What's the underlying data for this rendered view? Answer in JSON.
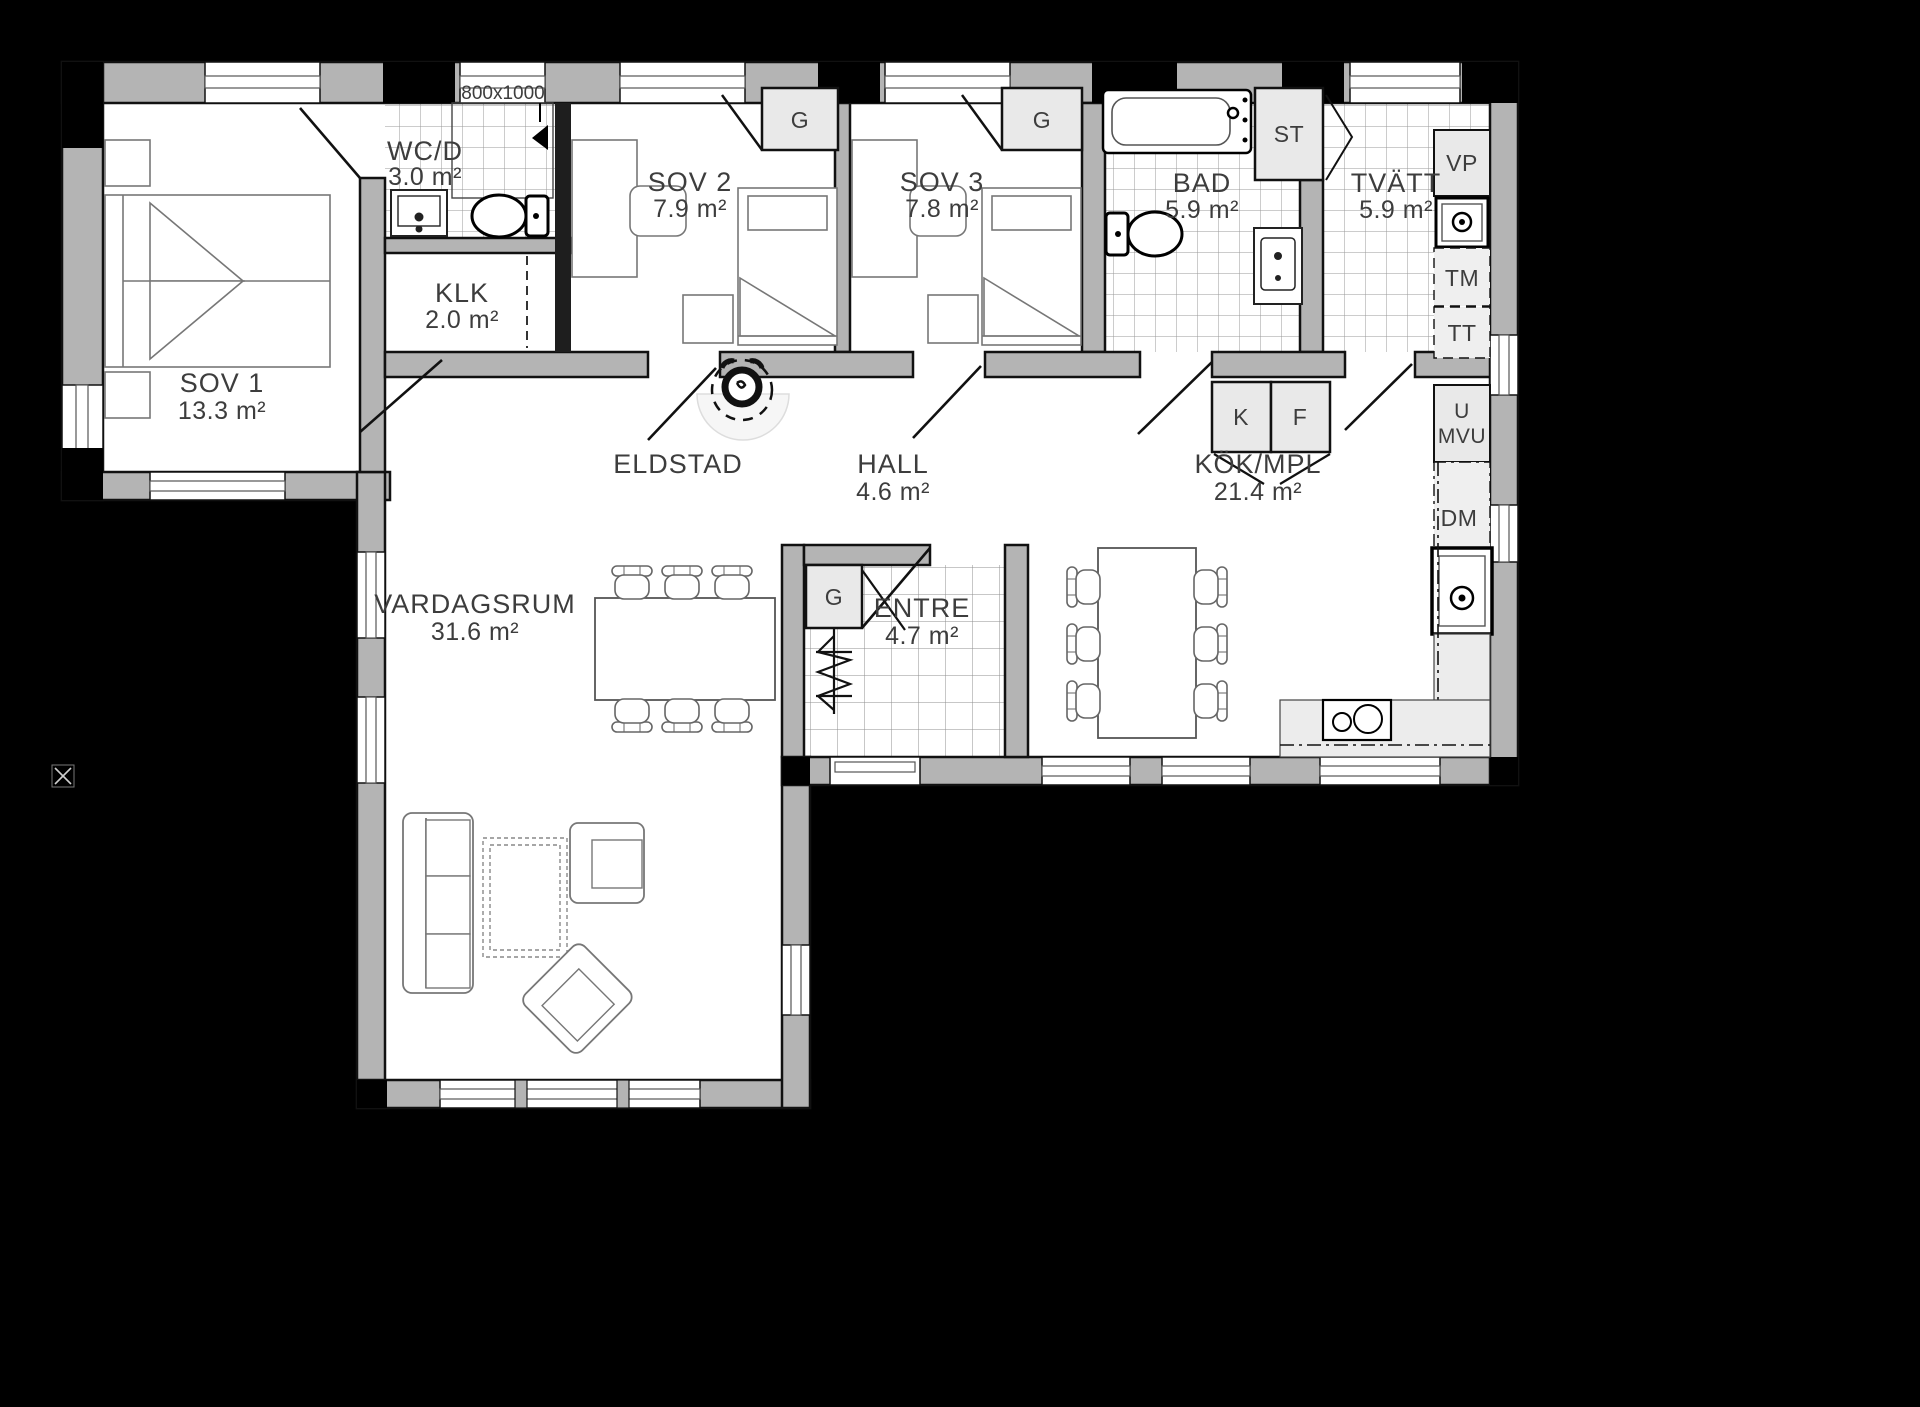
{
  "plan": {
    "type": "floorplan",
    "language": "Swedish",
    "colors": {
      "background": "#000000",
      "wall": "#b4b4b4",
      "floor": "#ffffff",
      "line": "#1c1c1c",
      "tile_line": "#9a9a9a",
      "cabinet_fill": "#e9e9e9",
      "label": "#3d3d3d"
    }
  },
  "rooms": {
    "sov1": {
      "name": "SOV 1",
      "area": "13.3 m²"
    },
    "wcd": {
      "name": "WC/D",
      "area": "3.0 m²"
    },
    "klk": {
      "name": "KLK",
      "area": "2.0 m²"
    },
    "sov2": {
      "name": "SOV 2",
      "area": "7.9 m²"
    },
    "sov3": {
      "name": "SOV 3",
      "area": "7.8 m²"
    },
    "bad": {
      "name": "BAD",
      "area": "5.9 m²"
    },
    "tvatt": {
      "name": "TVÄTT",
      "area": "5.9 m²"
    },
    "kok": {
      "name": "KÖK/MPL",
      "area": "21.4 m²"
    },
    "hall": {
      "name": "HALL",
      "area": "4.6 m²"
    },
    "entre": {
      "name": "ENTRE",
      "area": "4.7 m²"
    },
    "vardagsrum": {
      "name": "VARDAGSRUM",
      "area": "31.6 m²"
    },
    "eldstad": {
      "name": "ELDSTAD"
    }
  },
  "fixtures": {
    "shower_size": "800x1000",
    "wardrobe": "G",
    "cleaning_closet": "ST",
    "water_heater": "VP",
    "washing_machine": "TM",
    "dryer": "TT",
    "fridge": "K",
    "freezer": "F",
    "oven": "U",
    "microwave": "MVU",
    "dishwasher": "DM"
  }
}
